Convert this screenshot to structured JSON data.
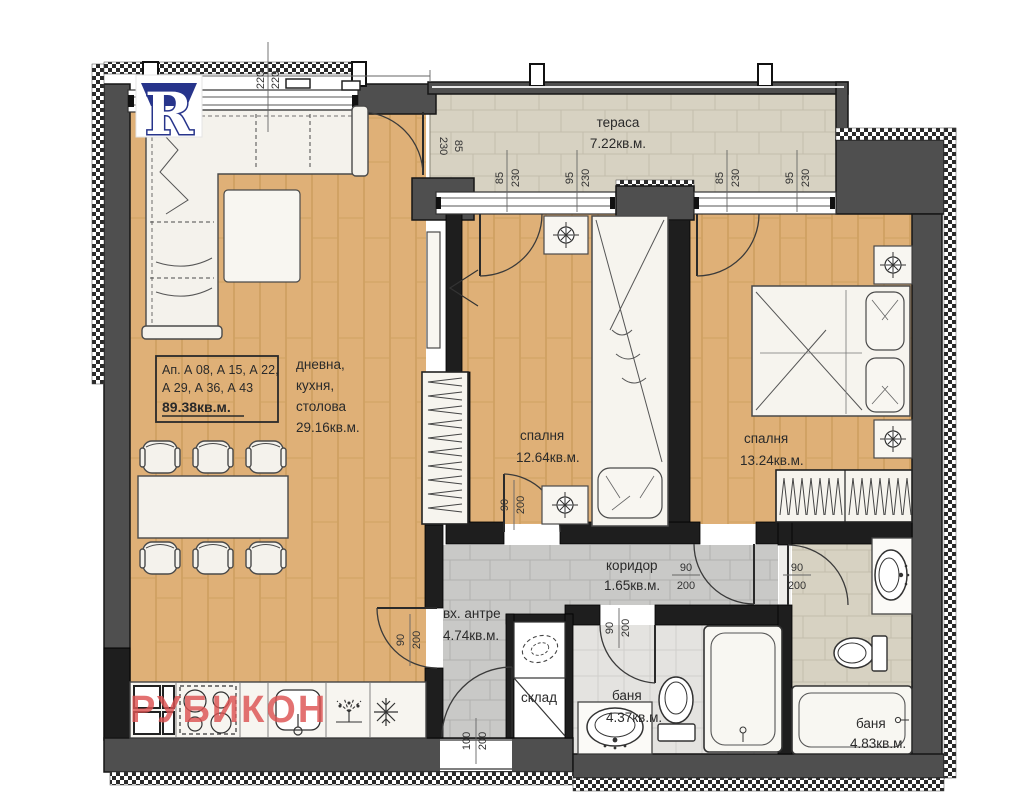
{
  "colors": {
    "wood": "#dfb077",
    "wood_line": "#c89a58",
    "tile_beige": "#d7d2c2",
    "tile_beige_line": "#c3bdac",
    "tile_gray": "#c9c9c7",
    "tile_gray_line": "#b1b1af",
    "tile_light": "#e4e3e0",
    "tile_light_line": "#d0cfcc",
    "wall_exterior": "#4f4f4f",
    "wall_interior": "#1e1e1e",
    "logo_blue": "#27348b",
    "watermark_red": "#dd5353"
  },
  "logo": {
    "letter": "R"
  },
  "watermark": {
    "text": "РУБИКОН"
  },
  "info_box": {
    "line1": "Ап. А 08, А 15, А 22,",
    "line2": "А 29, А 36, А 43",
    "area": "89.38кв.м."
  },
  "rooms": {
    "living": {
      "name_line1": "дневна,",
      "name_line2": "кухня,",
      "name_line3": "столова",
      "area": "29.16кв.м."
    },
    "terrace": {
      "name": "тераса",
      "area": "7.22кв.м."
    },
    "bedroom1": {
      "name": "спалня",
      "area": "12.64кв.м."
    },
    "bedroom2": {
      "name": "спалня",
      "area": "13.24кв.м."
    },
    "corridor": {
      "name": "коридор",
      "area": "1.65кв.м."
    },
    "entry": {
      "name": "вх. антре",
      "area": "4.74кв.м."
    },
    "storage": {
      "name": "склад"
    },
    "bath1": {
      "name": "баня",
      "area": "4.37кв.м."
    },
    "bath2": {
      "name": "баня",
      "area": "4.83кв.м."
    }
  },
  "dims": {
    "top": {
      "a": "220",
      "b": "220"
    },
    "terrace_left": {
      "a": "85",
      "b": "230"
    },
    "terrace_w1": {
      "a": "85",
      "b": "230"
    },
    "terrace_w2": {
      "a": "95",
      "b": "230"
    },
    "terrace_w3": {
      "a": "85",
      "b": "230"
    },
    "terrace_w4": {
      "a": "95",
      "b": "230"
    },
    "living_entry_door": {
      "a": "90",
      "b": "200"
    },
    "bedroom1_door": {
      "a": "90",
      "b": "200"
    },
    "bedroom2_door": {
      "a": "90",
      "b": "200"
    },
    "bath1_door": {
      "a": "90",
      "b": "200"
    },
    "bath2_door": {
      "a": "90",
      "b": "200"
    },
    "entrance_door": {
      "a": "100",
      "b": "200"
    }
  }
}
